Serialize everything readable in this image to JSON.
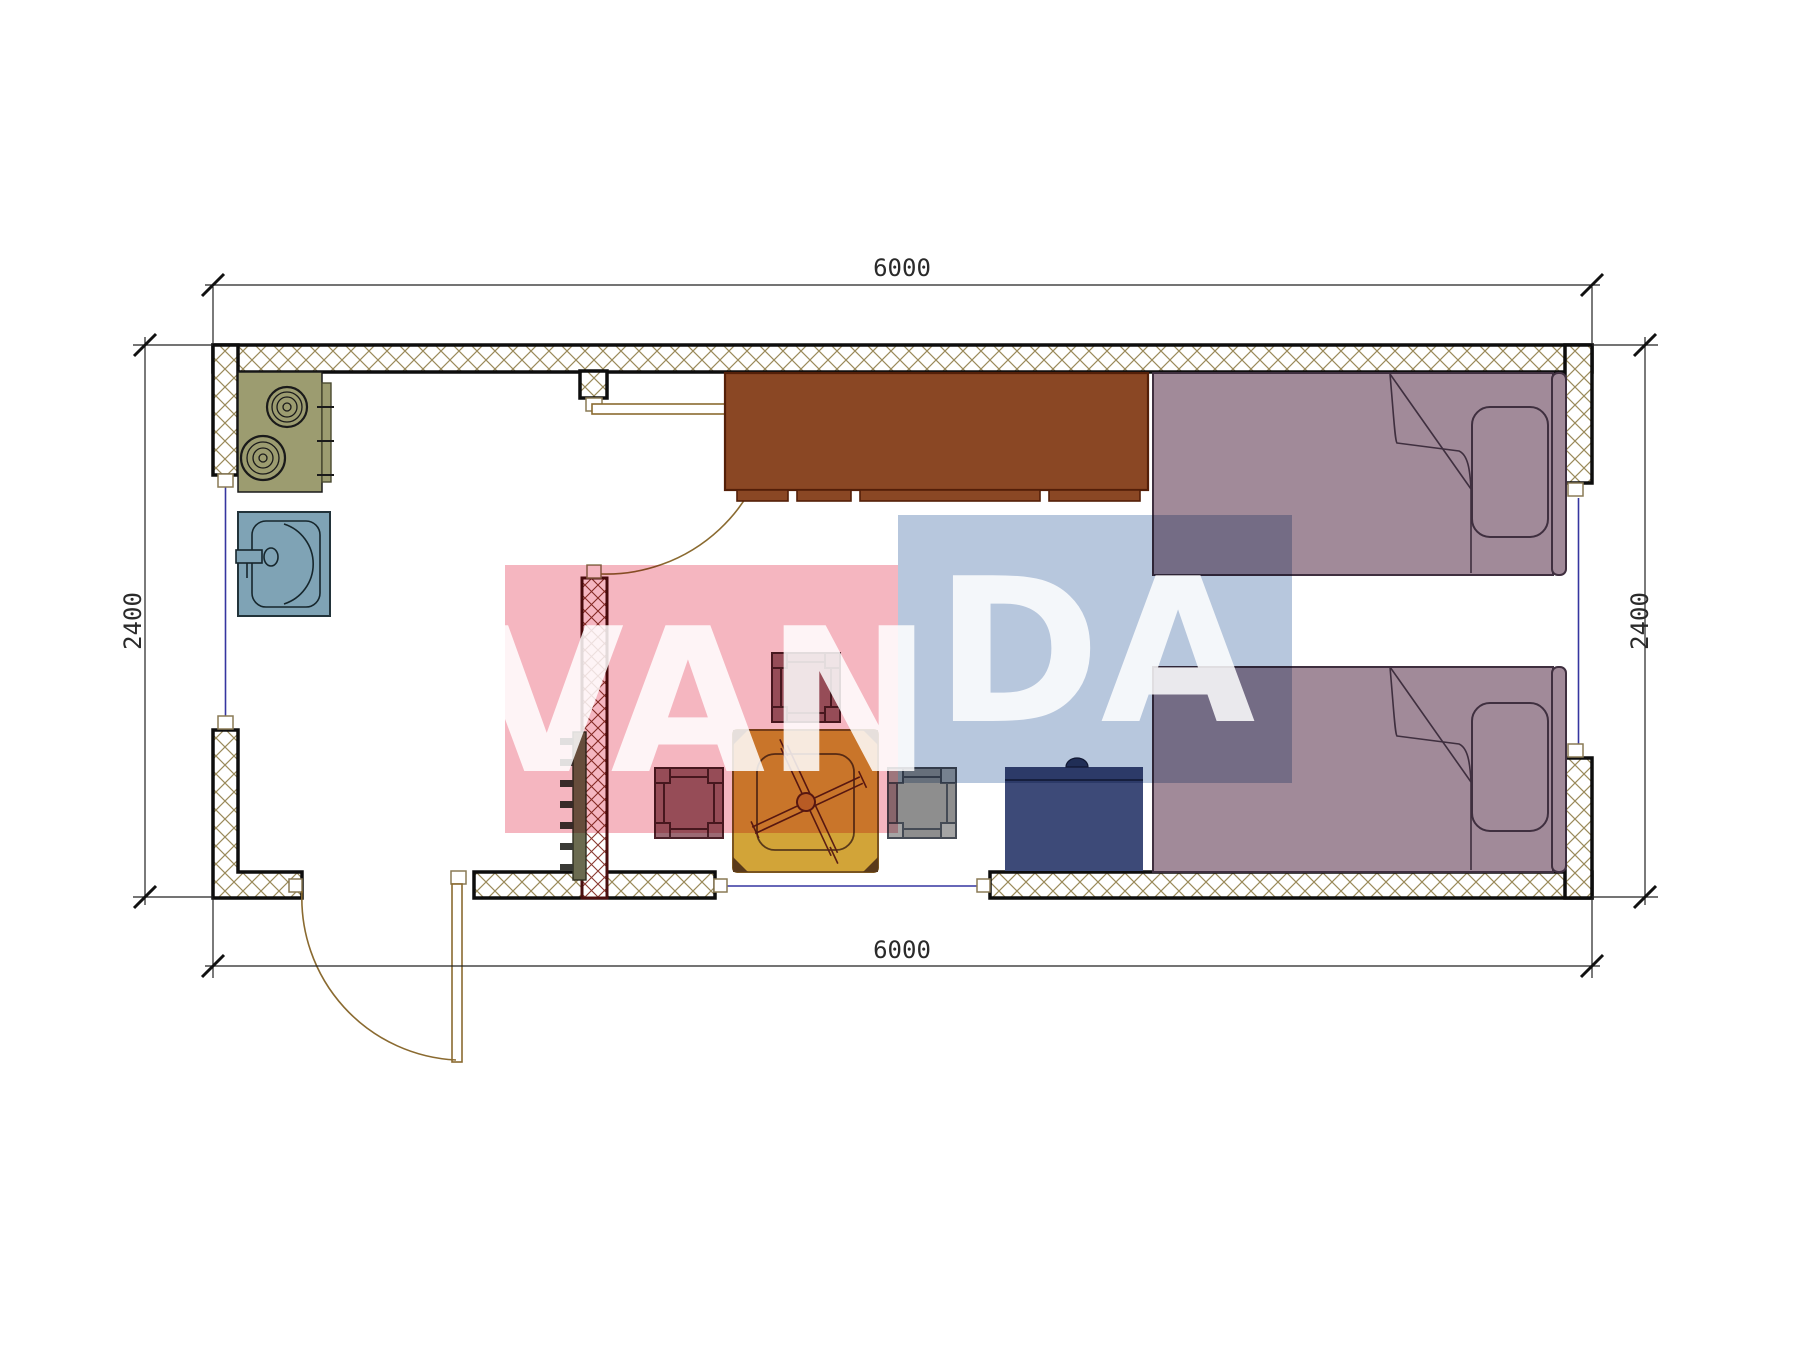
{
  "dimensions": {
    "top": "6000",
    "bottom": "6000",
    "left": "2400",
    "right": "2400"
  },
  "watermark": {
    "text_left": "VAN",
    "text_right": "DA",
    "pink_block": "#f5b6c0",
    "blue_block": "#b7c7dd",
    "letter_color": "rgba(255,255,255,0.85)"
  },
  "colors": {
    "wall_hatch": "#9a8a5a",
    "wall_outline": "#0d0d0d",
    "partition_hatch": "#8a3a30",
    "partition_outline": "#4a0f0f",
    "stove": "#9c9c70",
    "counter": "#9c9c70",
    "sink": "#7fa3b5",
    "cabinet": "#8a4724",
    "cabinet_outline": "#531f08",
    "bed": "#a18a99",
    "bed_outline": "#3f2f3f",
    "table": "#d2a438",
    "table_outline": "#7a5520",
    "table_legs": "#5a1f15",
    "stool": "#9c6a74",
    "stool_outline": "#4a2028",
    "stool_gray": "#8e8e8e",
    "stool_gray_outline": "#454b55",
    "nightstand": "#3d4a78",
    "nightstand_outline": "#141c38",
    "radiator": "#6b6b50",
    "radiator_teeth": "#3a3a35",
    "door_arc": "#8a6a30",
    "window_line": "#3535a0",
    "dim_line": "#222222"
  }
}
